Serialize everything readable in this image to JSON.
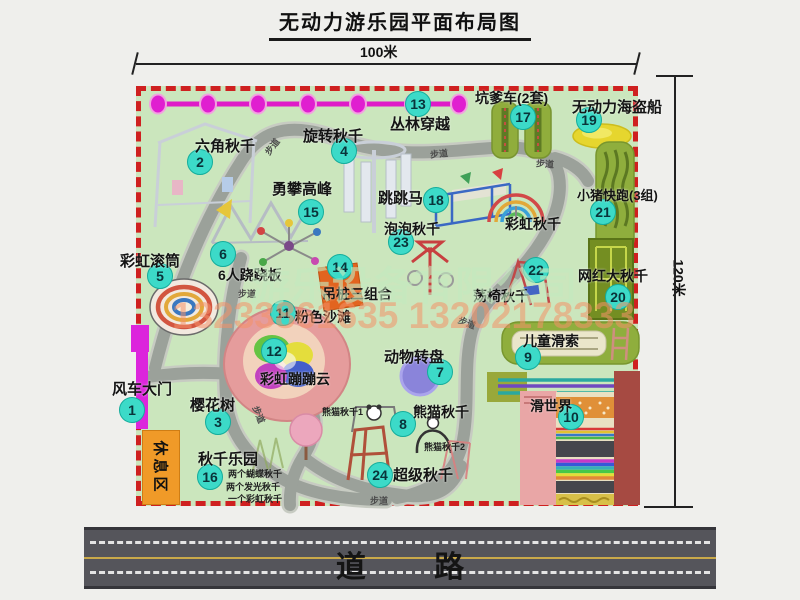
{
  "title": "无动力游乐园平面布局图",
  "dim": {
    "width_label": "100米",
    "height_label": "120米"
  },
  "watermarks": {
    "company": "游乐设备有限公司",
    "phone": "13233861635 13202178333"
  },
  "road": {
    "label": "道 路"
  },
  "rest_area": {
    "label": "休息区"
  },
  "path_label": "步道",
  "colors": {
    "map_bg": "#cbe6bd",
    "border_red": "#cf2020",
    "badge": "#3cdac8",
    "gate_magenta": "#dc25dc",
    "road_gray": "#55555b",
    "rest_orange": "#f09a28"
  },
  "attractions": [
    {
      "num": "1",
      "name": "风车大门",
      "badge": [
        132,
        410
      ],
      "label": [
        112,
        378
      ],
      "fs": 15
    },
    {
      "num": "2",
      "name": "六角秋千",
      "badge": [
        200,
        162
      ],
      "label": [
        195,
        135
      ],
      "fs": 15
    },
    {
      "num": "3",
      "name": "樱花树",
      "badge": [
        218,
        422
      ],
      "label": [
        190,
        394
      ],
      "fs": 15
    },
    {
      "num": "4",
      "name": "旋转秋千",
      "badge": [
        344,
        151
      ],
      "label": [
        303,
        125
      ],
      "fs": 15
    },
    {
      "num": "5",
      "name": "彩虹滚筒",
      "badge": [
        160,
        276
      ],
      "label": [
        120,
        250
      ],
      "fs": 15
    },
    {
      "num": "6",
      "name": "6人跷跷板",
      "badge": [
        223,
        254
      ],
      "label": [
        218,
        265
      ],
      "fs": 14
    },
    {
      "num": "7",
      "name": "动物转盘",
      "badge": [
        440,
        372
      ],
      "label": [
        384,
        346
      ],
      "fs": 15
    },
    {
      "num": "8",
      "name": "熊猫秋千",
      "badge": [
        403,
        424
      ],
      "label": [
        413,
        402
      ],
      "fs": 14
    },
    {
      "num": "9",
      "name": "儿童滑索",
      "badge": [
        528,
        357
      ],
      "label": [
        523,
        331
      ],
      "fs": 14
    },
    {
      "num": "10",
      "name": "滑世界",
      "badge": [
        571,
        417
      ],
      "label": [
        530,
        396
      ],
      "fs": 14
    },
    {
      "num": "11",
      "name": "粉色沙滩",
      "badge": [
        283,
        313
      ],
      "label": [
        295,
        307
      ],
      "fs": 14
    },
    {
      "num": "12",
      "name": "彩虹蹦蹦云",
      "badge": [
        274,
        351
      ],
      "label": [
        260,
        369
      ],
      "fs": 14
    },
    {
      "num": "13",
      "name": "丛林穿越",
      "badge": [
        418,
        104
      ],
      "label": [
        390,
        113
      ],
      "fs": 15
    },
    {
      "num": "14",
      "name": "吊桩三组合",
      "badge": [
        340,
        267
      ],
      "label": [
        322,
        284
      ],
      "fs": 14
    },
    {
      "num": "15",
      "name": "勇攀高峰",
      "badge": [
        311,
        212
      ],
      "label": [
        272,
        178
      ],
      "fs": 15
    },
    {
      "num": "16",
      "name": "秋千乐园",
      "badge": [
        210,
        477
      ],
      "label": [
        198,
        448
      ],
      "fs": 15
    },
    {
      "num": "17",
      "name": "坑爹车(2套)",
      "badge": [
        523,
        117
      ],
      "label": [
        475,
        88
      ],
      "fs": 14
    },
    {
      "num": "18",
      "name": "跳跳马",
      "badge": [
        436,
        200
      ],
      "label": [
        378,
        187
      ],
      "fs": 15
    },
    {
      "num": "19",
      "name": "无动力海盗船",
      "badge": [
        589,
        120
      ],
      "label": [
        572,
        96
      ],
      "fs": 15
    },
    {
      "num": "20",
      "name": "网红大秋千",
      "badge": [
        618,
        297
      ],
      "label": [
        578,
        266
      ],
      "fs": 14
    },
    {
      "num": "21",
      "name": "小猪快跑(3组)",
      "badge": [
        603,
        212
      ],
      "label": [
        577,
        185
      ],
      "fs": 13
    },
    {
      "num": "22",
      "name": "荡椅秋千",
      "badge": [
        536,
        270
      ],
      "label": [
        473,
        286
      ],
      "fs": 14
    },
    {
      "num": "23",
      "name": "泡泡秋千",
      "badge": [
        401,
        242
      ],
      "label": [
        384,
        219
      ],
      "fs": 14
    },
    {
      "num": "24",
      "name": "超级秋千",
      "badge": [
        380,
        475
      ],
      "label": [
        393,
        464
      ],
      "fs": 15
    },
    {
      "num": "",
      "name": "彩虹秋千",
      "label": [
        505,
        214
      ],
      "fs": 14
    }
  ],
  "sub_labels": [
    {
      "text": "熊猫秋千1",
      "x": 322,
      "y": 405
    },
    {
      "text": "熊猫秋千2",
      "x": 424,
      "y": 440
    },
    {
      "text": "两个蝴蝶秋千",
      "x": 228,
      "y": 467
    },
    {
      "text": "两个发光秋千",
      "x": 226,
      "y": 480
    },
    {
      "text": "一个彩虹秋千",
      "x": 228,
      "y": 492
    }
  ],
  "path_labels": [
    {
      "x": 263,
      "y": 140,
      "r": -52
    },
    {
      "x": 430,
      "y": 147,
      "r": -6
    },
    {
      "x": 536,
      "y": 157,
      "r": 4
    },
    {
      "x": 238,
      "y": 287,
      "r": 0
    },
    {
      "x": 458,
      "y": 316,
      "r": 22
    },
    {
      "x": 250,
      "y": 408,
      "r": 68
    },
    {
      "x": 370,
      "y": 494,
      "r": 0
    }
  ]
}
